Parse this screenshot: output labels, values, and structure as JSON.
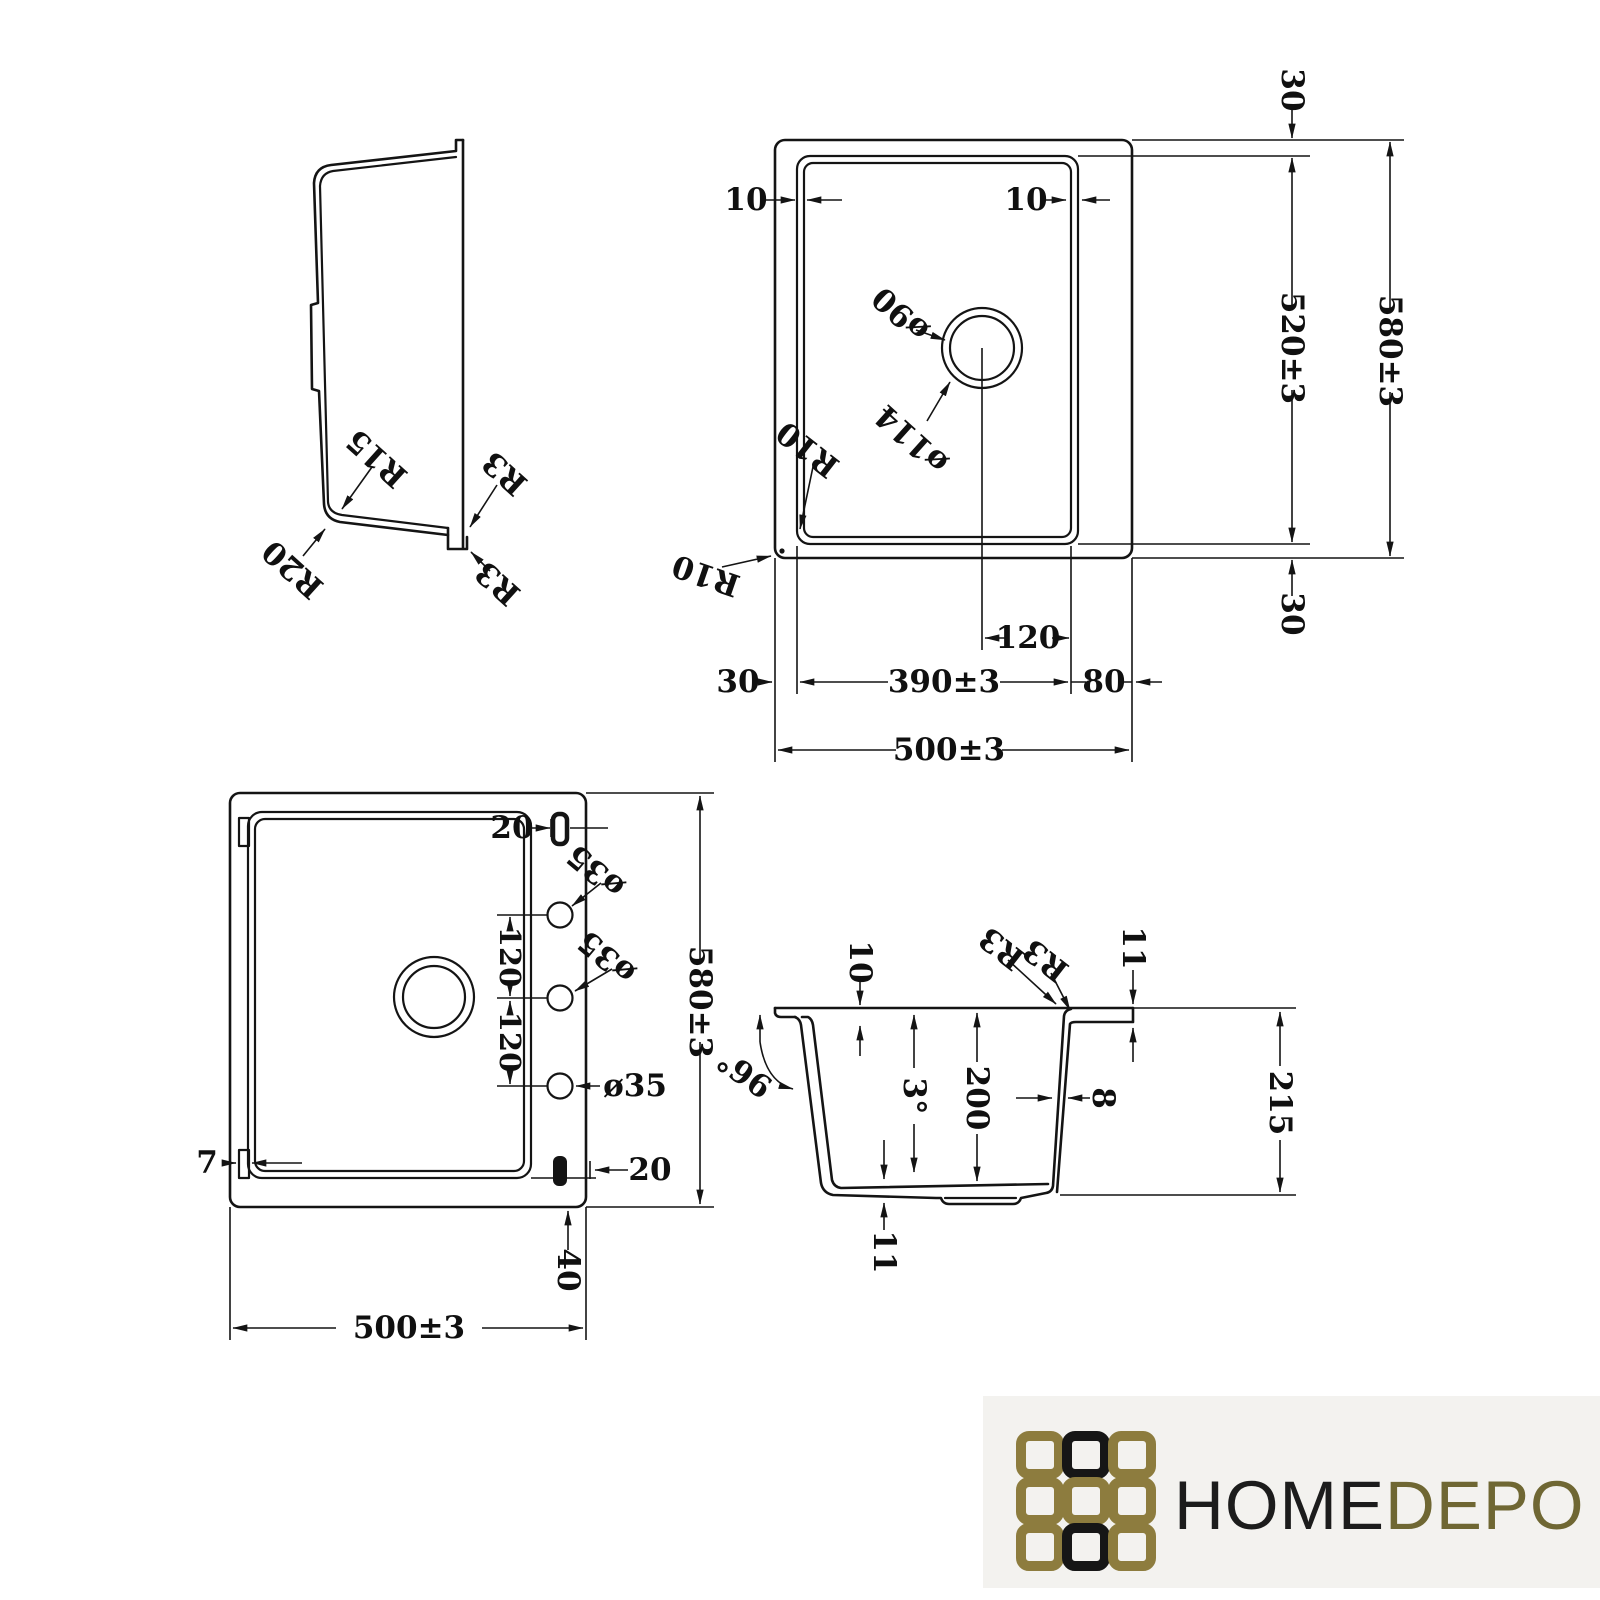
{
  "colors": {
    "line": "#141414",
    "logo_bg": "#f3f2ef"
  },
  "side_view": {
    "r15": "R15",
    "r20": "R20",
    "r3_inner": "R3",
    "r3_outer": "R3"
  },
  "top_view": {
    "rim_left": "10",
    "rim_right": "10",
    "margin_top": "30",
    "inner_length": "520±3",
    "overall_length": "580±3",
    "margin_bottom": "30",
    "drain_dia": "ø90",
    "drain_flange_dia": "ø114",
    "corner_inner": "R10",
    "corner_outer": "R10",
    "drain_offset": "120",
    "bowl_width": "390±3",
    "margin_left": "30",
    "margin_right": "80",
    "overall_width": "500±3"
  },
  "bottom_view": {
    "slot_top_offset": "20",
    "hole_top_dia": "ø35",
    "hole_mid_dia": "ø35",
    "hole_bottom_dia": "ø35",
    "hole_spacing_top": "120",
    "hole_spacing_bottom": "120",
    "overall_length": "580±3",
    "tab_width": "7",
    "slot_bottom_offset": "20",
    "base_offset": "40",
    "overall_width": "500±3"
  },
  "section_view": {
    "rim_inset": "10",
    "radius_a": "R3",
    "radius_b": "R3",
    "rim_thickness": "11",
    "rim_angle": "96°",
    "draft_angle": "3°",
    "bowl_depth": "200",
    "wall_thickness": "8",
    "overall_height": "215",
    "floor_thickness": "11"
  },
  "logo": {
    "home": "HOME",
    "depo": "DEPO",
    "text_black": "#1c1c1c",
    "text_gold": "#6f6733",
    "grid_gold": "#8d7c3e",
    "grid_black": "#161616"
  }
}
